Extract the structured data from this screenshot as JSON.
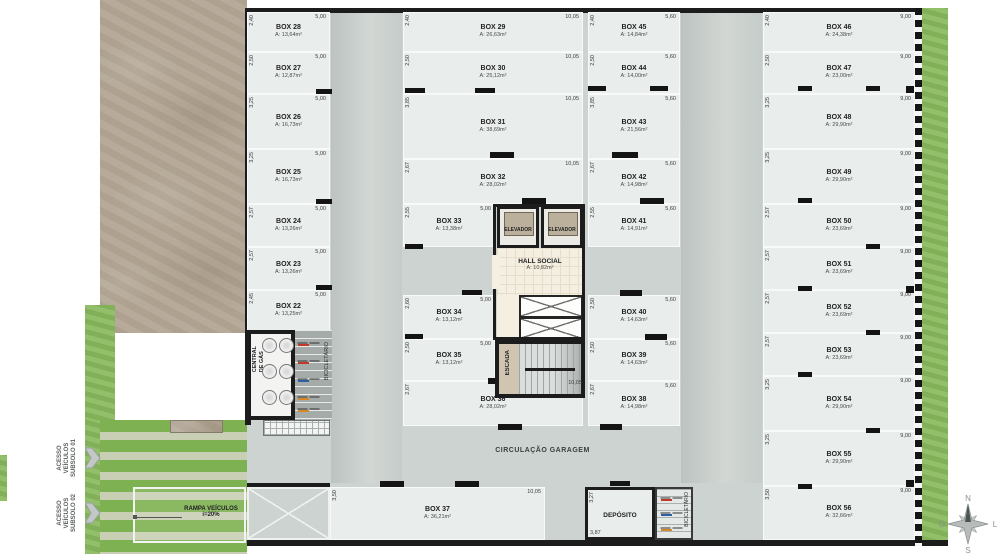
{
  "plan": {
    "boxes": [
      {
        "name": "BOX 28",
        "area": "A: 13,64m²",
        "wdim": "5,00",
        "hdim": "2,40"
      },
      {
        "name": "BOX 27",
        "area": "A: 12,87m²",
        "wdim": "5,00",
        "hdim": "2,50"
      },
      {
        "name": "BOX 26",
        "area": "A: 16,73m²",
        "wdim": "5,00",
        "hdim": "3,25"
      },
      {
        "name": "BOX 25",
        "area": "A: 16,73m²",
        "wdim": "5,00",
        "hdim": "3,25"
      },
      {
        "name": "BOX 24",
        "area": "A: 13,26m²",
        "wdim": "5,00",
        "hdim": "2,57"
      },
      {
        "name": "BOX 23",
        "area": "A: 13,26m²",
        "wdim": "5,00",
        "hdim": "2,57"
      },
      {
        "name": "BOX 22",
        "area": "A: 13,25m²",
        "wdim": "5,00",
        "hdim": "2,45"
      },
      {
        "name": "BOX 29",
        "area": "A: 26,63m²",
        "wdim": "10,05",
        "hdim": "2,40"
      },
      {
        "name": "BOX 30",
        "area": "A: 25,12m²",
        "wdim": "10,05",
        "hdim": "2,50"
      },
      {
        "name": "BOX 31",
        "area": "A: 38,69m²",
        "wdim": "10,05",
        "hdim": "3,85"
      },
      {
        "name": "BOX 32",
        "area": "A: 28,02m²",
        "wdim": "10,05",
        "hdim": "2,67"
      },
      {
        "name": "BOX 33",
        "area": "A: 13,38m²",
        "wdim": "5,00",
        "hdim": "2,55"
      },
      {
        "name": "BOX 34",
        "area": "A: 13,12m²",
        "wdim": "5,00",
        "hdim": "2,60"
      },
      {
        "name": "BOX 35",
        "area": "A: 13,12m²",
        "wdim": "5,00",
        "hdim": "2,50"
      },
      {
        "name": "BOX 36",
        "area": "A: 28,02m²",
        "wdim": "10,05",
        "hdim": "2,67"
      },
      {
        "name": "BOX 45",
        "area": "A: 14,84m²",
        "wdim": "5,60",
        "hdim": "2,40"
      },
      {
        "name": "BOX 44",
        "area": "A: 14,00m²",
        "wdim": "5,60",
        "hdim": "2,50"
      },
      {
        "name": "BOX 43",
        "area": "A: 21,56m²",
        "wdim": "5,60",
        "hdim": "3,85"
      },
      {
        "name": "BOX 42",
        "area": "A: 14,98m²",
        "wdim": "5,60",
        "hdim": "2,67"
      },
      {
        "name": "BOX 41",
        "area": "A: 14,91m²",
        "wdim": "5,60",
        "hdim": "2,55"
      },
      {
        "name": "BOX 40",
        "area": "A: 14,63m²",
        "wdim": "5,60",
        "hdim": "2,50"
      },
      {
        "name": "BOX 39",
        "area": "A: 14,63m²",
        "wdim": "5,60",
        "hdim": "2,50"
      },
      {
        "name": "BOX 38",
        "area": "A: 14,98m²",
        "wdim": "5,60",
        "hdim": "2,67"
      },
      {
        "name": "BOX 46",
        "area": "A: 24,38m²",
        "wdim": "9,00",
        "hdim": "2,40"
      },
      {
        "name": "BOX 47",
        "area": "A: 23,00m²",
        "wdim": "9,00",
        "hdim": "2,50"
      },
      {
        "name": "BOX 48",
        "area": "A: 29,90m²",
        "wdim": "9,00",
        "hdim": "3,25"
      },
      {
        "name": "BOX 49",
        "area": "A: 29,90m²",
        "wdim": "9,00",
        "hdim": "3,25"
      },
      {
        "name": "BOX 50",
        "area": "A: 23,69m²",
        "wdim": "9,00",
        "hdim": "2,57"
      },
      {
        "name": "BOX 51",
        "area": "A: 23,69m²",
        "wdim": "9,00",
        "hdim": "2,57"
      },
      {
        "name": "BOX 52",
        "area": "A: 23,69m²",
        "wdim": "9,00",
        "hdim": "2,57"
      },
      {
        "name": "BOX 53",
        "area": "A: 23,69m²",
        "wdim": "9,00",
        "hdim": "2,57"
      },
      {
        "name": "BOX 54",
        "area": "A: 29,90m²",
        "wdim": "9,00",
        "hdim": "3,25"
      },
      {
        "name": "BOX 55",
        "area": "A: 29,90m²",
        "wdim": "9,00",
        "hdim": "3,25"
      },
      {
        "name": "BOX 56",
        "area": "A: 32,66m²",
        "wdim": "9,00",
        "hdim": "3,50"
      },
      {
        "name": "BOX 37",
        "area": "A: 36,21m²",
        "wdim": "10,05",
        "hdim": "3,50"
      }
    ],
    "core": {
      "elevator1": "ELEVADOR",
      "elevator2": "ELEVADOR",
      "hall_name": "HALL SOCIAL",
      "hall_area": "A: 10,82m²",
      "stairs": "ESCADA",
      "bottom_dim": "10,05"
    },
    "rooms": {
      "gas_line1": "CENTRAL",
      "gas_line2": "DE GÁS",
      "bike_left": "BICICLETÁRIO",
      "bike_right": "BICICLETÁRIO",
      "deposit_name": "DEPÓSITO",
      "deposit_dim_top": "3,27",
      "deposit_dim_bottom": "3,87",
      "circulation": "CIRCULAÇÃO GARAGEM"
    },
    "ramp": {
      "line1": "RAMPA VEÍCULOS",
      "line2": "i=20%"
    },
    "access1": {
      "l1": "ACESSO",
      "l2": "VEÍCULOS",
      "l3": "SUBSOLO 01"
    },
    "access2": {
      "l1": "ACESSO",
      "l2": "VEÍCULOS",
      "l3": "SUBSOLO 02"
    },
    "compass": {
      "n": "N",
      "s": "S",
      "w": "O",
      "e": "L"
    }
  },
  "colors": {
    "wall": "#1c1c1c",
    "slab": "#cdd3d0",
    "box_floor": "#e9edeb",
    "grass": "#8aba5e",
    "ramp_green": "#7db151",
    "ramp_pale": "#c9cfb5",
    "terrain": "#b3a695",
    "hall_floor": "#f5efe2",
    "elevator_cab": "#bbb09b",
    "dim_text": "#3c3c3c"
  }
}
